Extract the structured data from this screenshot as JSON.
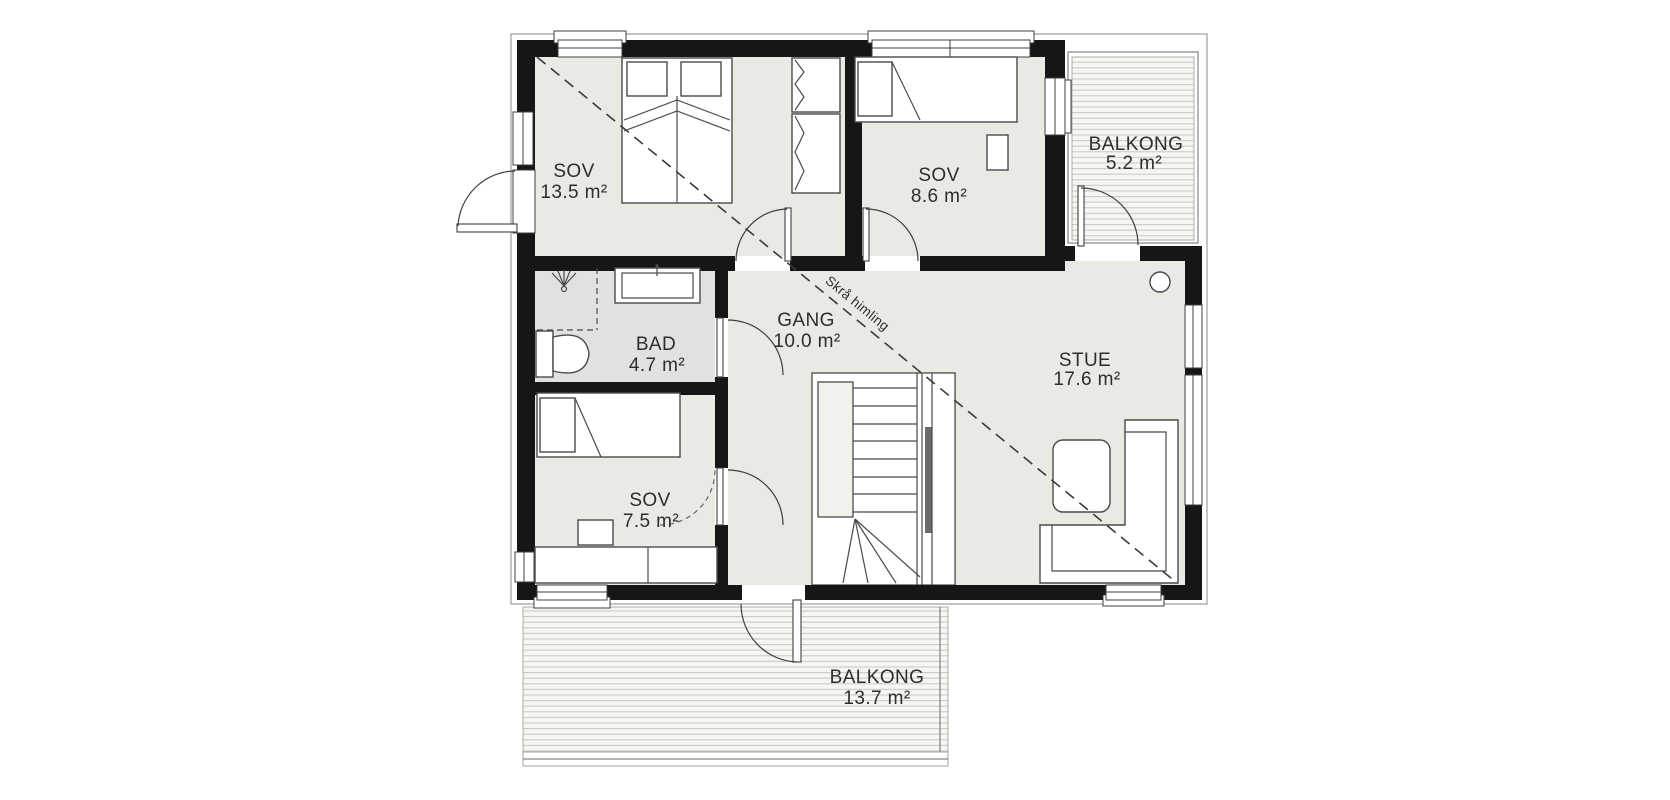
{
  "document": {
    "kind": "floor-plan"
  },
  "colors": {
    "wall": "#161616",
    "floor": "#eae9e3",
    "bathroom_floor": "#e1e1df",
    "deck_line": "#c6c6c2",
    "drawing_line": "#4a4a4a",
    "text": "#2d2d2d"
  },
  "rooms": {
    "sov1": {
      "name": "SOV",
      "area": "13.5 m²"
    },
    "sov2": {
      "name": "SOV",
      "area": "8.6 m²"
    },
    "sov3": {
      "name": "SOV",
      "area": "7.5 m²"
    },
    "bad": {
      "name": "BAD",
      "area": "4.7 m²"
    },
    "gang": {
      "name": "GANG",
      "area": "10.0 m²"
    },
    "stue": {
      "name": "STUE",
      "area": "17.6 m²"
    },
    "balkong_top": {
      "name": "BALKONG",
      "area": "5.2 m²"
    },
    "balkong_bottom": {
      "name": "BALKONG",
      "area": "13.7 m²"
    }
  },
  "annotations": {
    "sloped_ceiling": "Skrå himling"
  }
}
